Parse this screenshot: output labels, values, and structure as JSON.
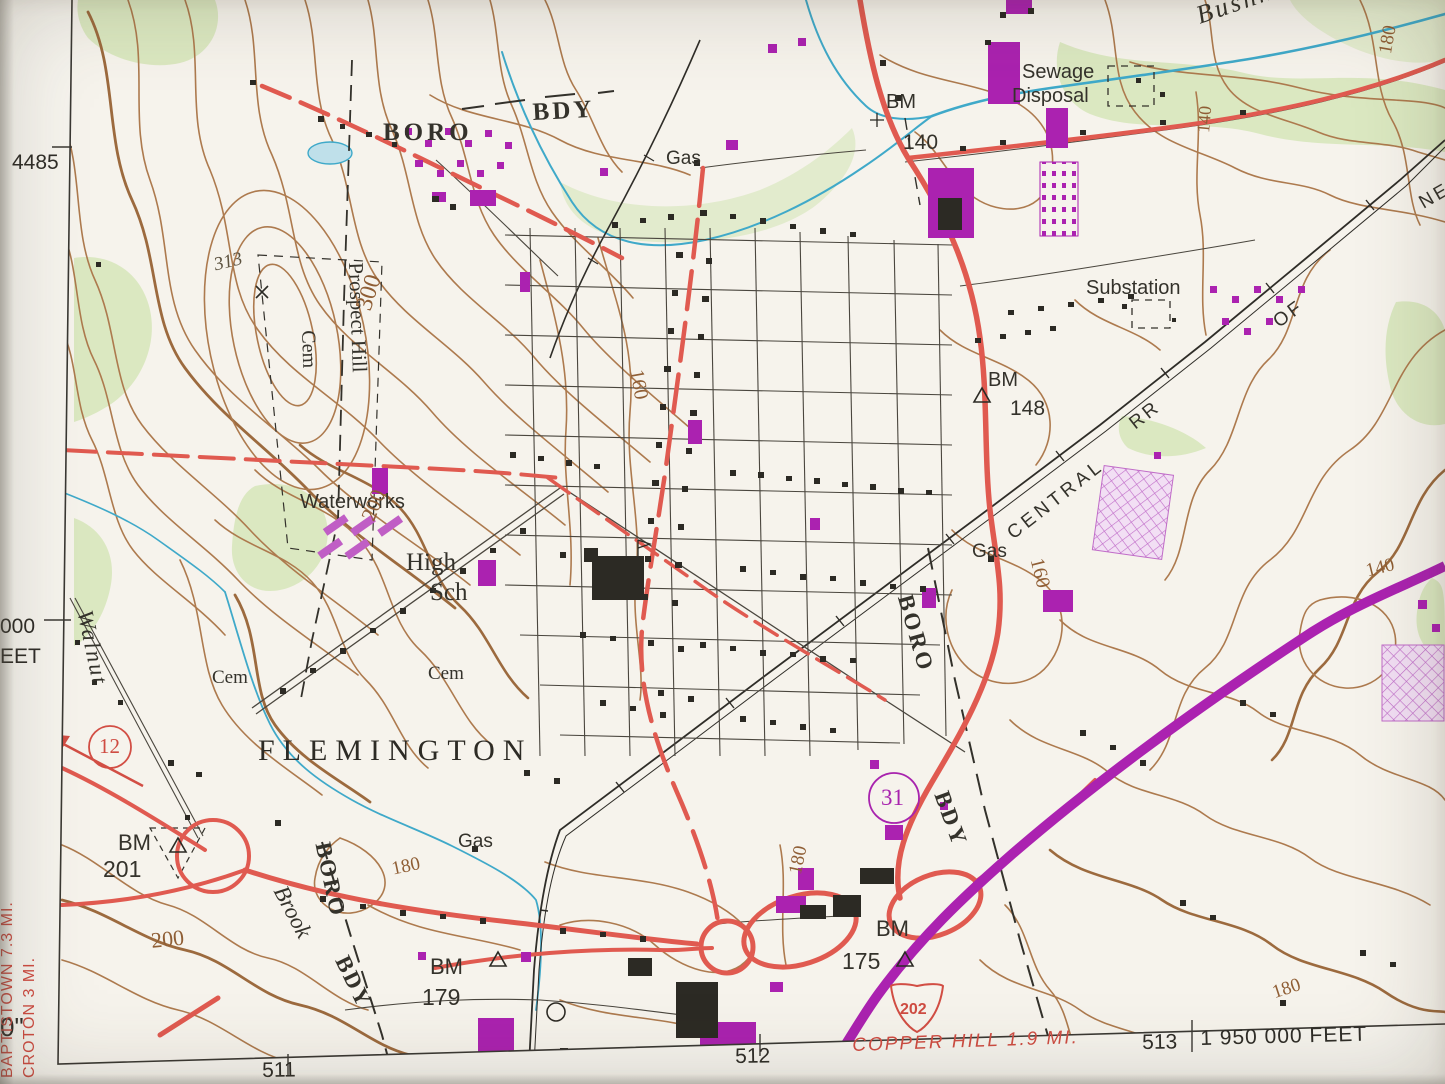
{
  "map_labels": {
    "bushkill": "Bushkill",
    "sewage_line1": "Sewage",
    "sewage_line2": "Disposal",
    "bm_140": "BM",
    "bm_140_val": "140",
    "boro_top": "BORO",
    "bdy_top": "BDY",
    "gas_top": "Gas",
    "substation": "Substation",
    "bm_148": "BM",
    "bm_148_val": "148",
    "rr_central": "CENTRAL",
    "rr_rr": "RR",
    "rr_of": "OF",
    "rr_ne": "NE",
    "prospect_hill": "Prospect Hill",
    "cem_prospect": "Cem",
    "spot_313": "313",
    "waterworks": "Waterworks",
    "high": "High",
    "sch": "Sch",
    "gas_mid": "Gas",
    "boro_right": "BORO",
    "bdy_right": "BDY",
    "walnut": "Walnut",
    "cem_west": "Cem",
    "cem_east": "Cem",
    "flemington": "FLEMINGTON",
    "boro_bl": "BORO",
    "brook": "Brook",
    "bdy_bl": "BDY",
    "gas_bottom": "Gas",
    "bm_201": "BM",
    "bm_201_val": "201",
    "bm_179": "BM",
    "bm_179_val": "179",
    "bm_175": "BM",
    "bm_175_val": "175"
  },
  "route_markers": {
    "route_12": "12",
    "route_31": "31",
    "route_202": "202"
  },
  "contour_labels": {
    "c300": "300",
    "c313x": "×",
    "c180_tr": "180",
    "c140_tr": "140",
    "c160_mid": "160",
    "c200_mid": "200",
    "c160_r": "160",
    "c140_r": "140",
    "c200_bl": "200",
    "c180_bl": "180",
    "c180_c": "180",
    "c180_br": "180"
  },
  "margin": {
    "grid_4485": "4485",
    "grid_000": "000",
    "grid_eet": "EET",
    "corner_0": "0\"",
    "grid_511": "511",
    "grid_512": "512",
    "grid_513": "513",
    "grid_feet": "1 950 000 FEET",
    "dest_baptistown": "BAPTISTOWN 7.3 MI.",
    "dest_croton": "CROTON 3 MI.",
    "dest_copper_hill": "COPPER HILL 1.9 MI."
  },
  "colors": {
    "paper": "#f6f3ec",
    "contour_brown": "#ad7a4e",
    "water_blue": "#3fa9c9",
    "road_red": "#e05a50",
    "highway_purple": "#ab22b0",
    "woodland_green": "#d8e7bd",
    "margin_red": "#cf4c42",
    "ink_black": "#34322b"
  }
}
